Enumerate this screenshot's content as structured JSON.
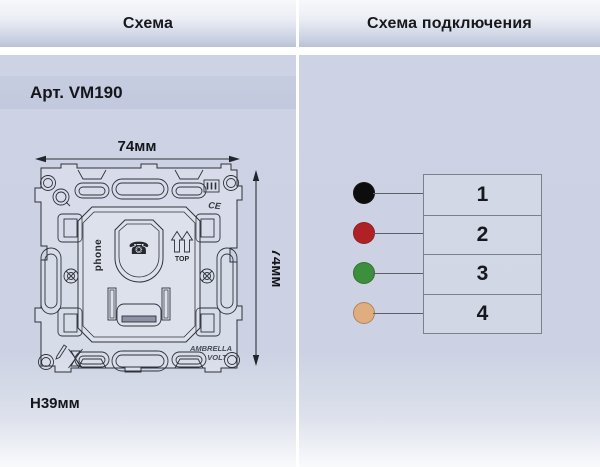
{
  "left_panel": {
    "header": "Схема",
    "article": "Арт. VM190",
    "dims": {
      "width": "74мм",
      "height": "74мм",
      "depth": "H39мм"
    },
    "drawing": {
      "module_label": "phone",
      "orientation_label": "TOP",
      "cert_label": "CE",
      "brand_line1": "AMBRELLA",
      "brand_line2": "VOLT",
      "phone_glyph": "☎"
    }
  },
  "right_panel": {
    "header": "Схема подключения",
    "terminals": [
      {
        "number": "1",
        "wire_name": "black",
        "wire_color": "#0d0d0d"
      },
      {
        "number": "2",
        "wire_name": "red",
        "wire_color": "#b02125"
      },
      {
        "number": "3",
        "wire_name": "green",
        "wire_color": "#3c8f3c"
      },
      {
        "number": "4",
        "wire_name": "tan",
        "wire_color": "#e0ae7e"
      }
    ]
  },
  "colors": {
    "panel_body": "#ccd2e3",
    "header_gradient_bottom": "#bac2d8",
    "drawing_line": "#2f323a",
    "table_border": "#7b808d"
  }
}
